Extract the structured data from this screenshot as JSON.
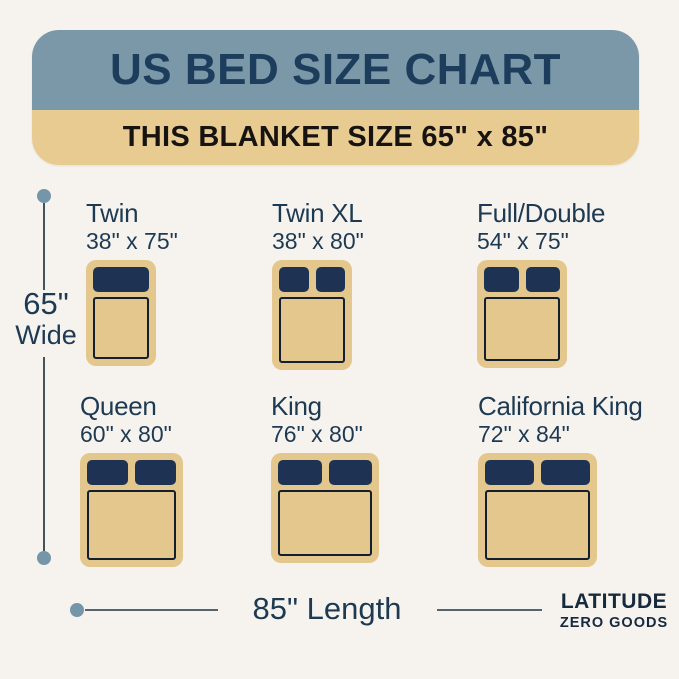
{
  "header": {
    "title": "US BED SIZE CHART",
    "subtitle": "THIS BLANKET SIZE 65\" x 85\""
  },
  "dimensions": {
    "width_value": "65\"",
    "width_label": "Wide",
    "length_label": "85\" Length"
  },
  "beds": [
    {
      "name": "Twin",
      "size": "38\" x 75\"",
      "pillows": 1
    },
    {
      "name": "Twin XL",
      "size": "38\" x 80\"",
      "pillows": 2
    },
    {
      "name": "Full/Double",
      "size": "54\" x 75\"",
      "pillows": 2
    },
    {
      "name": "Queen",
      "size": "60\" x 80\"",
      "pillows": 2
    },
    {
      "name": "King",
      "size": "76\" x 80\"",
      "pillows": 2
    },
    {
      "name": "California King",
      "size": "72\" x 84\"",
      "pillows": 2
    }
  ],
  "brand": {
    "line1": "LATITUDE",
    "line2": "ZERO GOODS"
  },
  "colors": {
    "background": "#f6f3ef",
    "header_blue": "#7b98a8",
    "banner_tan": "#e8cb90",
    "bed_tan": "#e4c78c",
    "pillow_navy": "#1e3353",
    "mattress_outline": "#131f2e",
    "text_navy": "#1e3a52",
    "title_navy": "#1d3d5c",
    "subtitle_black": "#171310",
    "dot_blue": "#7595a8",
    "line_gray": "#55646f"
  }
}
